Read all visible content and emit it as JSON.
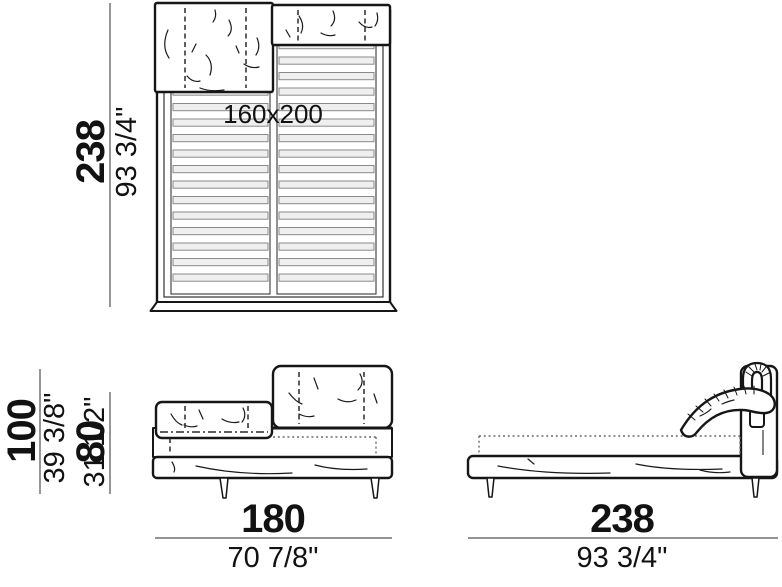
{
  "views": {
    "top": {
      "mattress_size": "160x200",
      "length": {
        "cm": "238",
        "inches": "93 3/4\""
      }
    },
    "front": {
      "height_headboard": {
        "cm": "100",
        "inches": "39 3/8\""
      },
      "height_low_headboard": {
        "cm": "80",
        "inches": "31 1/2\""
      },
      "width": {
        "cm": "180",
        "inches": "70 7/8\""
      }
    },
    "side": {
      "length": {
        "cm": "238",
        "inches": "93 3/4\""
      }
    }
  },
  "colors": {
    "line": "#1a1a1a",
    "dimension_line": "#848484",
    "slat_fill": "#efefef",
    "background": "#ffffff"
  }
}
